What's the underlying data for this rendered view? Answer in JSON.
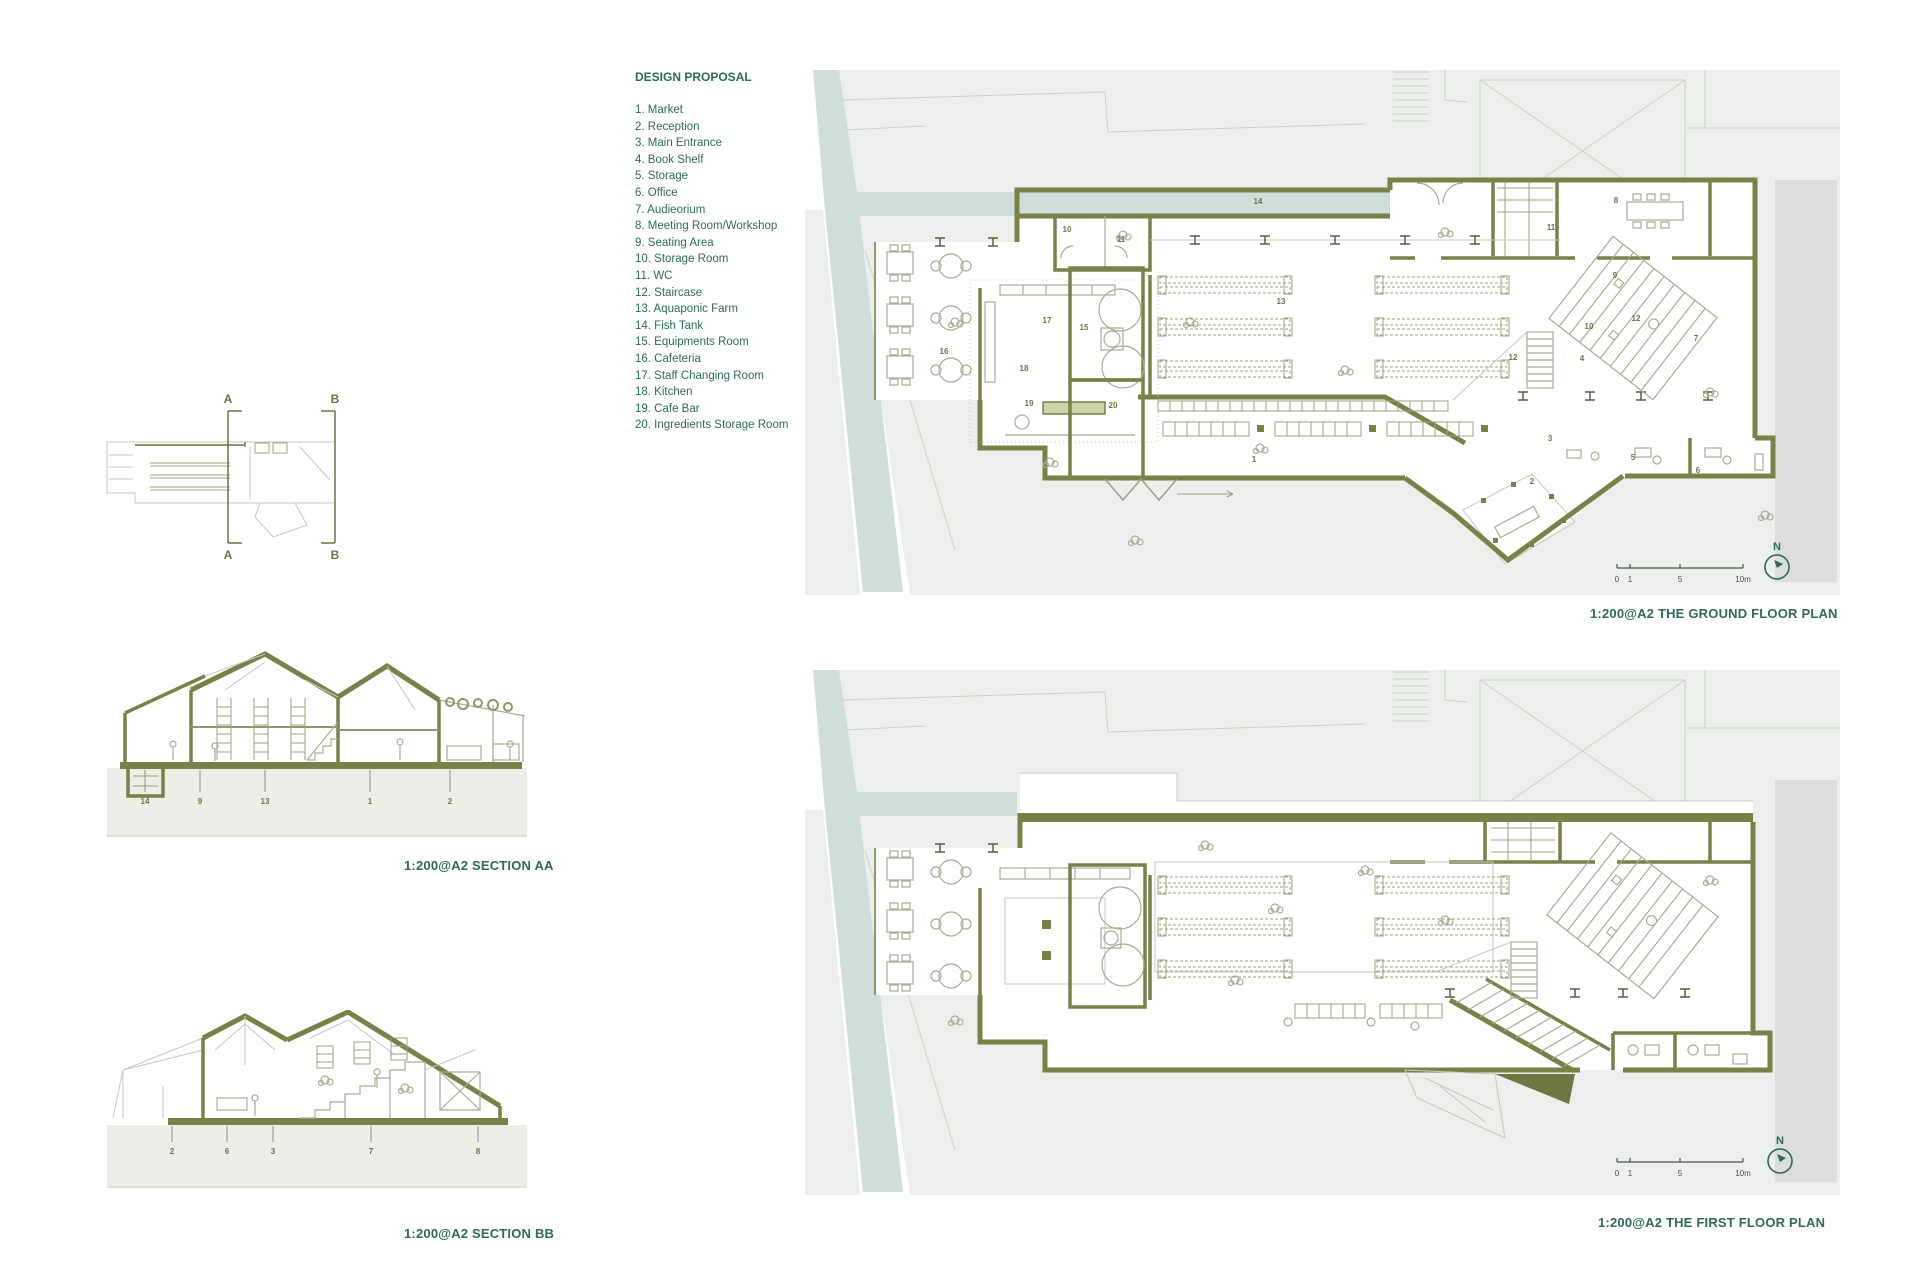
{
  "colors": {
    "wall_olive": "#798148",
    "text_green": "#2d6b58",
    "label_olive": "#6d7540",
    "site_gray": "#ecefeb",
    "water_blue": "#cfdeda",
    "ground_beige": "#edeee7"
  },
  "legend": {
    "title": "DESIGN PROPOSAL",
    "items": [
      "1. Market",
      "2. Reception",
      "3. Main Entrance",
      "4. Book Shelf",
      "5. Storage",
      "6. Office",
      "7. Audieorium",
      "8. Meeting Room/Workshop",
      "9. Seating Area",
      "10. Storage Room",
      "11. WC",
      "12. Staircase",
      "13. Aquaponic Farm",
      "14. Fish Tank",
      "15. Equipments Room",
      "16. Cafeteria",
      "17. Staff Changing Room",
      "18. Kitchen",
      "19. Cafe Bar",
      "20. Ingredients Storage Room"
    ]
  },
  "key_plan": {
    "a_top": "A",
    "a_bottom": "A",
    "b_top": "B",
    "b_bottom": "B"
  },
  "sections": {
    "aa": {
      "caption": "1:200@A2 SECTION AA",
      "labels": [
        "14",
        "9",
        "13",
        "1",
        "2"
      ]
    },
    "bb": {
      "caption": "1:200@A2 SECTION BB",
      "labels": [
        "2",
        "6",
        "3",
        "7",
        "8"
      ]
    }
  },
  "ground_floor": {
    "caption": "1:200@A2 THE GROUND FLOOR PLAN",
    "north": "N",
    "scale_ticks": [
      "0",
      "1",
      "5",
      "10m"
    ],
    "room_labels": [
      "14",
      "10",
      "11",
      "17",
      "15",
      "18",
      "19",
      "16",
      "20",
      "13",
      "1",
      "12",
      "11",
      "8",
      "9",
      "10",
      "4",
      "12",
      "7",
      "3",
      "2",
      "5",
      "6"
    ]
  },
  "first_floor": {
    "caption": "1:200@A2 THE FIRST FLOOR PLAN",
    "north": "N",
    "scale_ticks": [
      "0",
      "1",
      "5",
      "10m"
    ]
  }
}
